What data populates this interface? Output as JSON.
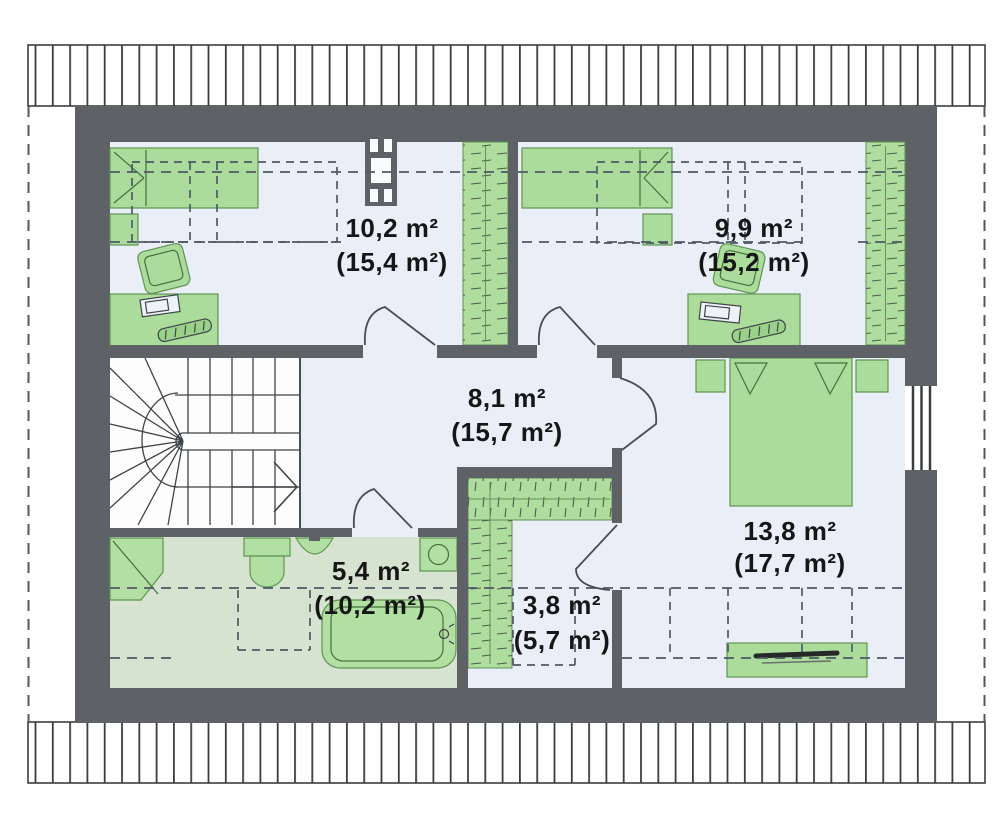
{
  "plan": {
    "type": "attic-floor-plan",
    "rooms": {
      "room1": {
        "name": "bedroom-top-left",
        "area": "10,2 m²",
        "total_area": "(15,4 m²)"
      },
      "room2": {
        "name": "bedroom-top-right",
        "area": "9,9 m²",
        "total_area": "(15,2 m²)"
      },
      "hall": {
        "name": "hall-with-stairs",
        "area": "8,1 m²",
        "total_area": "(15,7 m²)"
      },
      "bedroom": {
        "name": "bedroom-right",
        "area": "13,8 m²",
        "total_area": "(17,7 m²)"
      },
      "bathroom": {
        "name": "bathroom",
        "area": "5,4 m²",
        "total_area": "(10,2 m²)"
      },
      "wardrobe": {
        "name": "walk-in-closet",
        "area": "3,8 m²",
        "total_area": "(5,7 m²)"
      }
    },
    "fixtures": {
      "room1": [
        "single-bed",
        "nightstand",
        "armchair",
        "desk-with-computer",
        "built-in-wardrobe",
        "chimney"
      ],
      "room2": [
        "single-bed",
        "nightstand",
        "armchair",
        "desk-with-computer",
        "built-in-wardrobe"
      ],
      "bedroom": [
        "double-bed",
        "nightstand-left",
        "nightstand-right",
        "dresser-with-tv",
        "window"
      ],
      "bathroom": [
        "corner-shower",
        "toilet",
        "washbasin",
        "washing-machine",
        "bathtub"
      ],
      "hall": [
        "winder-staircase"
      ],
      "wardrobe": [
        "l-shaped-shelving"
      ]
    },
    "colors": {
      "wall": "#5e6266",
      "floor": "#e9eef7",
      "bathroom_floor": "#d6e3d0",
      "furniture_fill": "#abdc9b",
      "furniture_stroke": "#5f9454",
      "dash_line": "#4e5a66",
      "roof_hatch": "#3b3e40",
      "label_text": "#161616"
    }
  }
}
